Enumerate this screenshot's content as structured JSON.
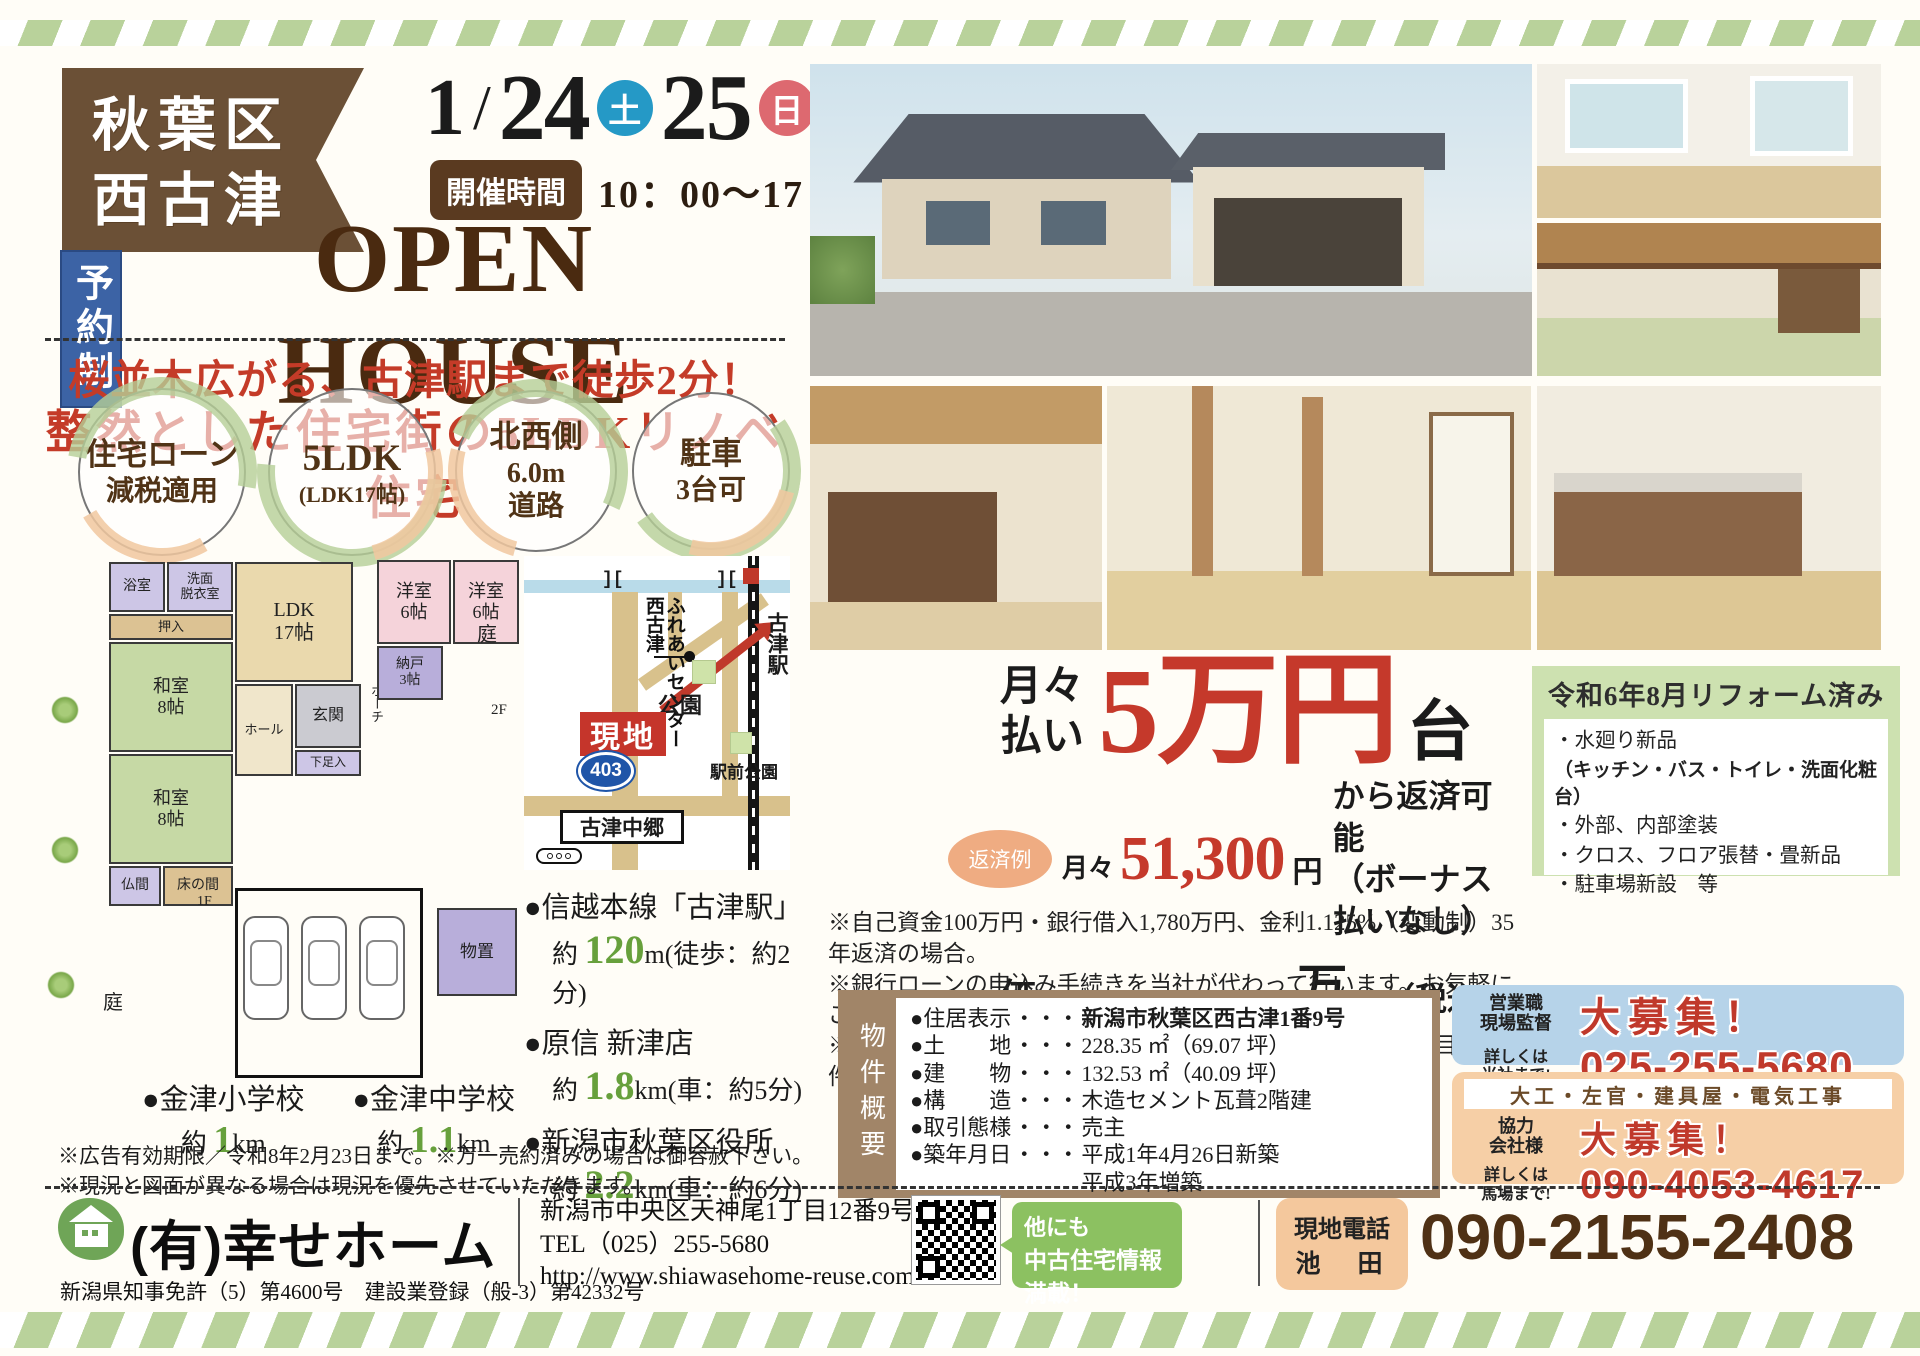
{
  "header": {
    "area_line1": "秋葉区",
    "area_line2": "西古津",
    "date_month": "1",
    "date_slash": "/",
    "day1": "24",
    "day1_dow": "土",
    "day2": "25",
    "day2_dow": "日",
    "time_label": "開催時間",
    "time_value": "10：00～17：00",
    "reserve": "予約制",
    "title": "OPEN HOUSE",
    "catch1": "桜並木広がる、古津駅まで徒歩2分！",
    "catch2": "整然とした住宅街の5LDKリノベ住宅"
  },
  "features": [
    {
      "line1": "住宅ローン",
      "line2": "減税適用"
    },
    {
      "line1": "5LDK",
      "line2": "(LDK17帖)"
    },
    {
      "line1": "北西側",
      "line2": "6.0m\n道路"
    },
    {
      "line1": "駐車",
      "line2": "3台可"
    }
  ],
  "floorplan": {
    "rooms": {
      "bath": "浴室",
      "senmen": "洗面\n脱衣室",
      "oshiire": "押入",
      "ldk": "LDK\n17帖",
      "washitsu1": "和室\n8帖",
      "washitsu2": "和室\n8帖",
      "butsuma": "仏間",
      "tokonoma": "床の間",
      "hall": "ホール",
      "genkan": "玄関",
      "geta": "下足入",
      "porch": "ポーチ",
      "yoshitsu1": "洋室\n6帖",
      "yoshitsu2": "洋室\n6帖",
      "nando": "納戸\n3帖",
      "monooki": "物置",
      "niwa1": "庭",
      "niwa2": "庭",
      "f1": "1F",
      "f2": "2F"
    }
  },
  "map": {
    "center": "西古津\nふれあいセンター",
    "park": "公園",
    "site": "現地",
    "route": "403",
    "station": "古津駅",
    "station_park": "駅前公園",
    "crossing": "古津中郷"
  },
  "access": [
    {
      "name": "●信越本線「古津駅」",
      "approx": "約",
      "value": "120",
      "unit": "m",
      "note": "(徒歩：約2分)"
    },
    {
      "name": "●原信 新津店",
      "approx": "約",
      "value": "1.8",
      "unit": "km",
      "note": "(車：約5分)"
    },
    {
      "name": "●新潟市秋葉区役所",
      "approx": "約",
      "value": "2.2",
      "unit": "km",
      "note": "(車：約6分)"
    }
  ],
  "schools": [
    {
      "name": "●金津小学校",
      "approx": "約",
      "value": "1",
      "unit": "km"
    },
    {
      "name": "●金津中学校",
      "approx": "約",
      "value": "1.1",
      "unit": "km"
    }
  ],
  "disclaimer1": "※広告有効期限／令和8年2月23日まで。※万一売約済みの場合は御容赦下さい。",
  "disclaimer2": "※現況と図面が異なる場合は現況を優先させていただきます。",
  "price": {
    "monthly_label": "月々\n払い",
    "big_value": "5万円",
    "big_suffix": "台",
    "example_badge": "返済例",
    "example_prefix": "月々",
    "example_value": "51,300",
    "example_unit": "円",
    "example_note": "から返済可能\n（ボーナス払いなし）",
    "price_label": "価格",
    "price_value": "1,880",
    "price_unit": "万円",
    "price_tax": "（税込み）",
    "notes": [
      "※自己資金100万円・銀行借入1,780万円、金利1.125%（変動制）35年返済の場合。",
      "※銀行ローンの申込み手続きを当社が代わって行います。お気軽にご相談下さい。",
      "※別途不動産取得費用・ローン手続き費用が掛かります。（目安：物件価格の約5～8%）"
    ]
  },
  "reform": {
    "title": "令和6年8月リフォーム済み",
    "items": [
      "・水廻り新品",
      "（キッチン・バス・トイレ・洗面化粧台）",
      "・外部、内部塗装",
      "・クロス、フロア張替・畳新品",
      "・駐車場新設　等"
    ]
  },
  "property": {
    "side_label": "物件概要",
    "rows": [
      {
        "label": "●住居表示",
        "dots": "・・・",
        "value": "新潟市秋葉区西古津1番9号"
      },
      {
        "label": "●土　　地",
        "dots": "・・・",
        "value": "228.35 ㎡（69.07 坪）"
      },
      {
        "label": "●建　　物",
        "dots": "・・・",
        "value": "132.53 ㎡（40.09 坪）"
      },
      {
        "label": "●構　　造",
        "dots": "・・・",
        "value": "木造セメント瓦葺2階建"
      },
      {
        "label": "●取引態様",
        "dots": "・・・",
        "value": "売主"
      },
      {
        "label": "●築年月日",
        "dots": "・・・",
        "value": "平成1年4月26日新築\n平成3年増築"
      }
    ]
  },
  "recruit": {
    "sales_role": "営業職\n現場監督",
    "sales_big": "大募集！",
    "sales_note": "詳しくは\n当社まで!",
    "sales_phone": "025-255-5680",
    "partner_trades": "大工・左官・建具屋・電気工事",
    "partner_role": "協力\n会社様",
    "partner_big": "大募集！",
    "partner_note": "詳しくは\n馬場まで!",
    "partner_phone": "090-4053-4617"
  },
  "footer": {
    "company": "(有)幸せホーム",
    "license": "新潟県知事免許（5）第4600号　建設業登録（般-3）第42332号",
    "address": "新潟市中央区天神尾1丁目12番9号",
    "tel": "TEL（025）255-5680",
    "url": "http://www.shiawasehome-reuse.com",
    "bubble_line1": "他にも",
    "bubble_line2": "中古住宅情報満載！",
    "site_phone_label": "現地電話",
    "site_phone_name": "池　田",
    "site_phone": "090-2155-2408"
  }
}
